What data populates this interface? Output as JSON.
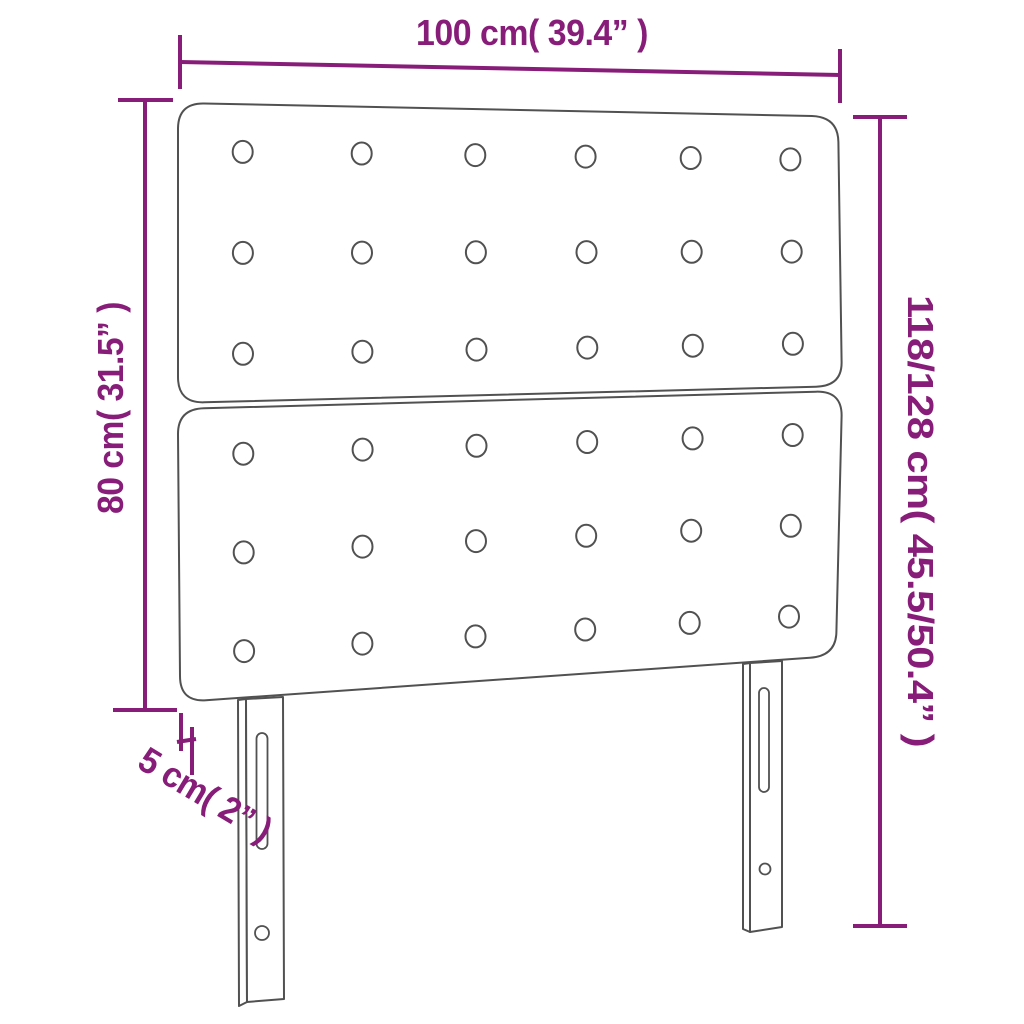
{
  "diagram": {
    "kind": "product-dimension-diagram",
    "subject": "upholstered headboard, two stacked tufted panels with two slotted legs",
    "labels": {
      "width": "100 cm( 39.4” )",
      "total_height": "118/128 cm( 45.5/50.4” )",
      "panel_height": "80 cm( 31.5” )",
      "depth": "5 cm( 2” )"
    },
    "buttons": {
      "panels": 2,
      "rows_per_panel": 3,
      "columns": 6
    },
    "colors": {
      "dimension": "#871d79",
      "outline": "#515151",
      "background": "#ffffff"
    }
  }
}
